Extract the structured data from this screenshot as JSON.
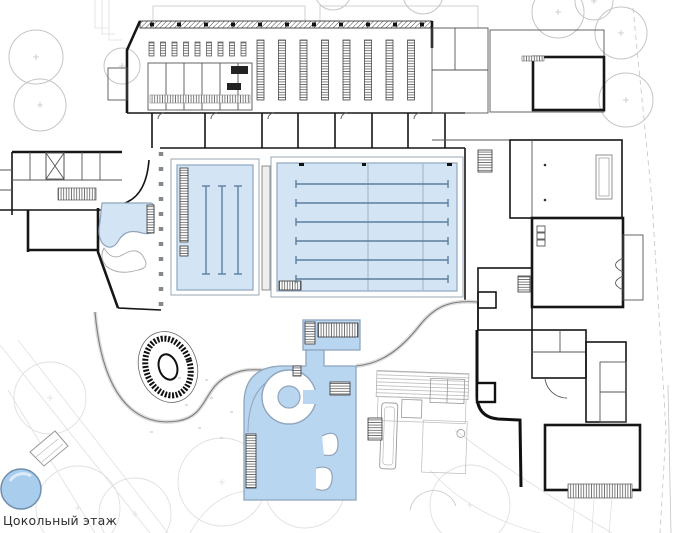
{
  "caption": {
    "label": "Цокольный этаж"
  },
  "colors": {
    "background": "#ffffff",
    "wall": "#161616",
    "wall_light": "#555555",
    "landscape": "#c5c5c5",
    "landscape_faint": "#e0e0e0",
    "pool_fill": "#d3e5f5",
    "pool_edge": "#8fa5bd",
    "lane_line": "#5d7f9f",
    "leisure_fill": "#b9d6f0",
    "plunge_fill": "#a9cdec",
    "caption_text": "#2f2f2f"
  },
  "plan": {
    "floor_label": "Цокольный этаж",
    "main_pool": {
      "name": "main-competition-pool",
      "lane_count": 6,
      "lane_x0": 296,
      "lane_x1": 448,
      "lane_y0": 184,
      "lane_y1": 279
    },
    "training_pool": {
      "name": "training-pool",
      "lane_count": 3,
      "lane_x0": 206,
      "lane_x1": 238,
      "lane_y0": 186,
      "lane_y1": 274
    },
    "locker_hall": {
      "tall_rows": 8,
      "tall_x0": 257,
      "tall_step": 21.5,
      "tall_y": 40,
      "tall_h": 60,
      "short_rows": 9,
      "short_x0": 149,
      "short_step": 11.5,
      "short_y": 42,
      "short_h": 14,
      "columns": 11,
      "col_x0": 150,
      "col_step": 27,
      "col_y": 21
    },
    "trees": [
      {
        "x": 36,
        "y": 57,
        "r": 27
      },
      {
        "x": 122,
        "y": 66,
        "r": 18
      },
      {
        "x": 40,
        "y": 105,
        "r": 26
      },
      {
        "x": 333,
        "y": -8,
        "r": 18
      },
      {
        "x": 423,
        "y": -6,
        "r": 20
      },
      {
        "x": 558,
        "y": 12,
        "r": 26
      },
      {
        "x": 594,
        "y": 1,
        "r": 19
      },
      {
        "x": 621,
        "y": 33,
        "r": 26
      },
      {
        "x": 626,
        "y": 100,
        "r": 27
      }
    ],
    "contour_circles": [
      {
        "x": 50,
        "y": 398,
        "r": 36
      },
      {
        "x": 78,
        "y": 508,
        "r": 42
      },
      {
        "x": 135,
        "y": 514,
        "r": 36
      },
      {
        "x": 222,
        "y": 482,
        "r": 44
      },
      {
        "x": 305,
        "y": 488,
        "r": 40
      },
      {
        "x": 470,
        "y": 505,
        "r": 40
      }
    ]
  }
}
